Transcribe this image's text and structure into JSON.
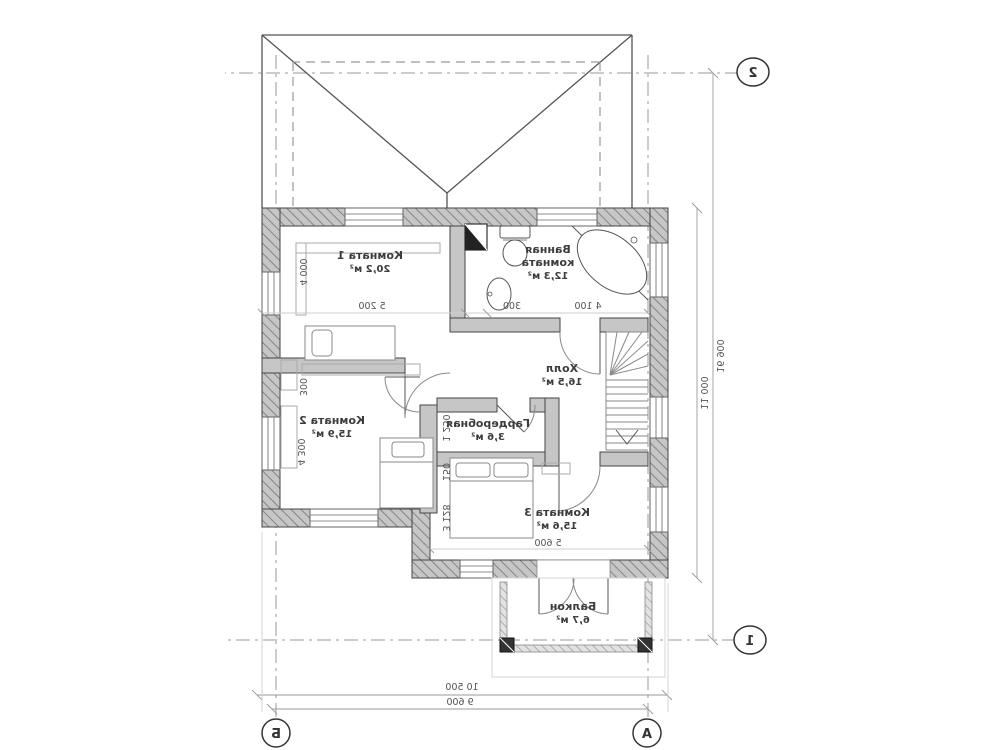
{
  "drawing": {
    "rooms": {
      "room1": {
        "name": "Комната 1",
        "area": "20,2 м²"
      },
      "bathroom": {
        "name_line1": "Ванная",
        "name_line2": "комната",
        "area": "12,3 м²"
      },
      "hall": {
        "name": "Холл",
        "area": "16,5 м²"
      },
      "room2": {
        "name": "Комната 2",
        "area": "15,9 м²"
      },
      "wardrobe": {
        "name": "Гардеробная",
        "area": "3,6 м²"
      },
      "room3": {
        "name": "Комната 3",
        "area": "15,6 м²"
      },
      "balcony": {
        "name": "Балкон",
        "area": "6,7 м²"
      }
    },
    "dimensions": {
      "top_bath": "4 100",
      "top_gap": "300",
      "top_room1": "5 200",
      "left_room1": "4 000",
      "left_gap": "300",
      "left_room2": "4 300",
      "mid_wardrobe": "1 250",
      "mid_gap": "150",
      "mid_room3": "3 128",
      "room3_width": "5 600",
      "bottom_overall": "10 500",
      "bottom_axes": "9 600",
      "right_overall": "16 900",
      "right_depth": "11 000"
    },
    "grid": {
      "axis_2": "2",
      "axis_1": "1",
      "axis_b": "Б",
      "axis_a": "А"
    },
    "colors": {
      "wall": "#c6c6c6",
      "line": "#444444",
      "dim_line": "#9a9a9a",
      "hatch": "#848484"
    }
  }
}
